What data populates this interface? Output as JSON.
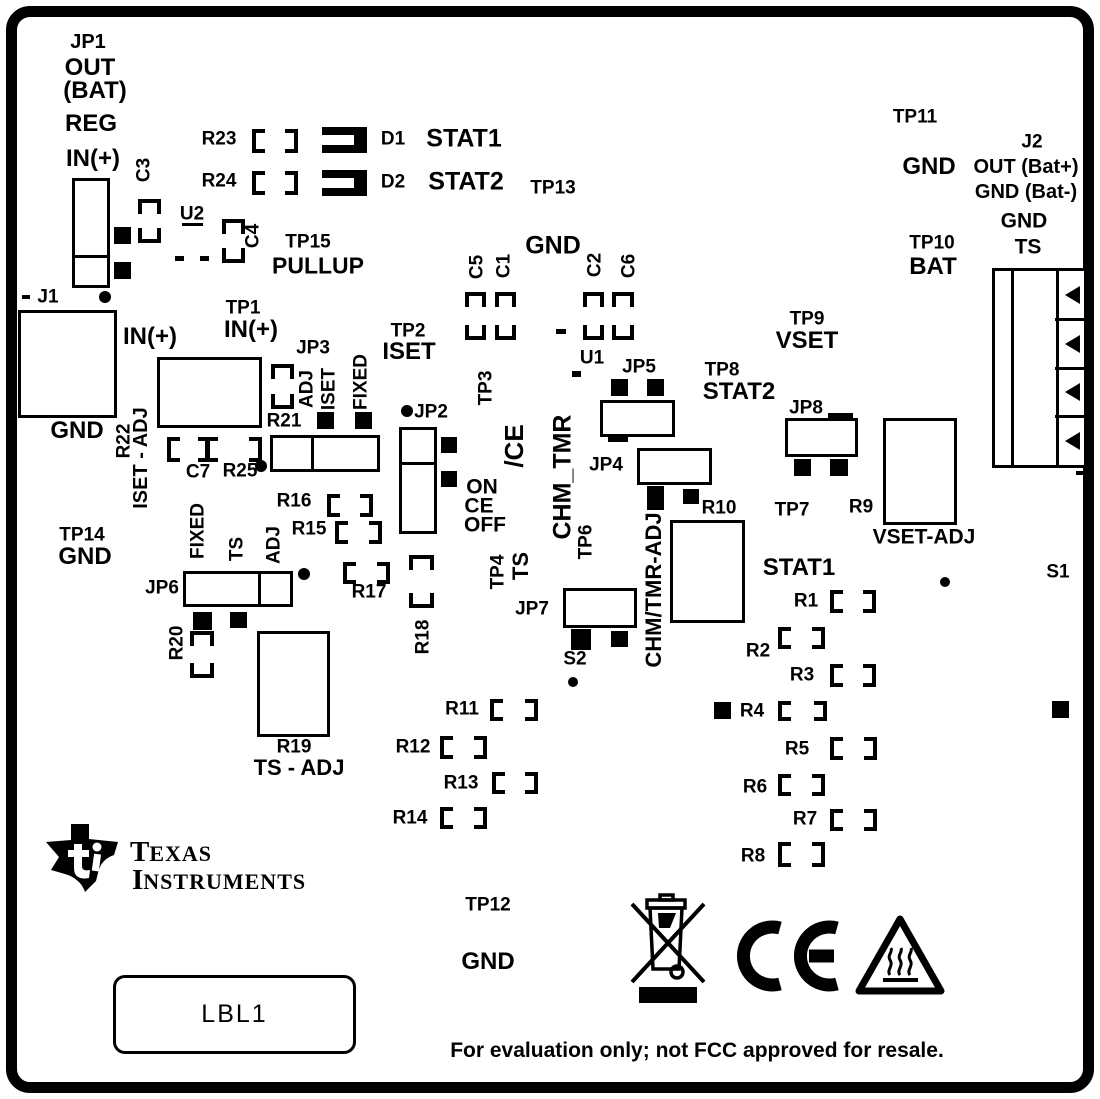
{
  "board": {
    "bg": "#ffffff",
    "ink": "#000000"
  },
  "brand": {
    "t1i": "T",
    "t1r": "EXAS",
    "t2i": "I",
    "t2r": "NSTRUMENTS"
  },
  "plate": {
    "text": "LBL1"
  },
  "footer": {
    "text": "For evaluation only; not FCC approved for resale."
  },
  "labels": [
    [
      "JP1",
      88,
      42,
      20,
      ""
    ],
    [
      "OUT",
      90,
      68,
      24,
      ""
    ],
    [
      "(BAT)",
      95,
      91,
      24,
      ""
    ],
    [
      "REG",
      91,
      124,
      24,
      ""
    ],
    [
      "IN(+)",
      93,
      159,
      24,
      ""
    ],
    [
      "C3",
      144,
      170,
      19,
      "v"
    ],
    [
      "U2",
      192,
      214,
      19,
      ""
    ],
    [
      "C4",
      253,
      236,
      19,
      "v"
    ],
    [
      "TP15",
      308,
      242,
      19,
      ""
    ],
    [
      "PULLUP",
      318,
      266,
      23,
      ""
    ],
    [
      "R23",
      219,
      139,
      19,
      ""
    ],
    [
      "R24",
      219,
      181,
      19,
      ""
    ],
    [
      "D1",
      393,
      139,
      19,
      ""
    ],
    [
      "STAT1",
      464,
      139,
      25,
      ""
    ],
    [
      "D2",
      393,
      182,
      19,
      ""
    ],
    [
      "STAT2",
      466,
      182,
      25,
      ""
    ],
    [
      "TP13",
      553,
      188,
      19,
      ""
    ],
    [
      "GND",
      553,
      246,
      25,
      ""
    ],
    [
      "C5",
      477,
      267,
      19,
      "v"
    ],
    [
      "C1",
      504,
      266,
      19,
      "v"
    ],
    [
      "C2",
      595,
      265,
      19,
      "v"
    ],
    [
      "C6",
      629,
      266,
      19,
      "v"
    ],
    [
      "TP11",
      915,
      117,
      19,
      ""
    ],
    [
      "GND",
      929,
      167,
      24,
      ""
    ],
    [
      "J2",
      1032,
      142,
      19,
      ""
    ],
    [
      "OUT (Bat+)",
      1026,
      167,
      20,
      ""
    ],
    [
      "GND (Bat-)",
      1026,
      192,
      20,
      ""
    ],
    [
      "GND",
      1024,
      221,
      21,
      ""
    ],
    [
      "TS",
      1028,
      247,
      21,
      ""
    ],
    [
      "TP10",
      932,
      243,
      19,
      ""
    ],
    [
      "BAT",
      933,
      267,
      24,
      ""
    ],
    [
      "J1",
      48,
      297,
      19,
      ""
    ],
    [
      "IN(+)",
      150,
      337,
      24,
      ""
    ],
    [
      "GND",
      77,
      431,
      24,
      ""
    ],
    [
      "TP1",
      243,
      308,
      19,
      ""
    ],
    [
      "IN(+)",
      251,
      330,
      24,
      ""
    ],
    [
      "TP2",
      408,
      331,
      19,
      ""
    ],
    [
      "ISET",
      409,
      352,
      24,
      ""
    ],
    [
      "JP3",
      313,
      348,
      19,
      ""
    ],
    [
      "ADJ",
      307,
      389,
      19,
      "v"
    ],
    [
      "ISET",
      329,
      389,
      19,
      "v"
    ],
    [
      "FIXED",
      361,
      382,
      19,
      "v"
    ],
    [
      "R22",
      124,
      441,
      19,
      "v"
    ],
    [
      "ISET - ADJ",
      141,
      458,
      20,
      "v"
    ],
    [
      "R21",
      284,
      421,
      19,
      ""
    ],
    [
      "C7",
      198,
      472,
      19,
      ""
    ],
    [
      "R25",
      240,
      471,
      19,
      ""
    ],
    [
      "TP9",
      807,
      319,
      19,
      ""
    ],
    [
      "VSET",
      807,
      341,
      24,
      ""
    ],
    [
      "U1",
      592,
      358,
      19,
      ""
    ],
    [
      "JP5",
      639,
      367,
      19,
      ""
    ],
    [
      "TP8",
      722,
      370,
      19,
      ""
    ],
    [
      "STAT2",
      739,
      392,
      24,
      ""
    ],
    [
      "JP2",
      431,
      412,
      19,
      ""
    ],
    [
      "ON",
      482,
      487,
      21,
      ""
    ],
    [
      "CE",
      479,
      506,
      21,
      ""
    ],
    [
      "OFF",
      485,
      525,
      21,
      ""
    ],
    [
      "/CE",
      514,
      446,
      26,
      "v"
    ],
    [
      "TP3",
      486,
      388,
      19,
      "v"
    ],
    [
      "CHM_TMR",
      563,
      477,
      25,
      "v"
    ],
    [
      "JP4",
      606,
      465,
      19,
      ""
    ],
    [
      "JP8",
      806,
      408,
      19,
      ""
    ],
    [
      "R9",
      861,
      507,
      19,
      ""
    ],
    [
      "VSET-ADJ",
      924,
      537,
      21,
      ""
    ],
    [
      "TP7",
      792,
      510,
      19,
      ""
    ],
    [
      "R10",
      719,
      508,
      19,
      ""
    ],
    [
      "CHM/TMR-ADJ",
      654,
      590,
      22,
      "v"
    ],
    [
      "TP4",
      498,
      572,
      19,
      "v"
    ],
    [
      "TS",
      521,
      566,
      22,
      "v"
    ],
    [
      "TP6",
      586,
      542,
      19,
      "v"
    ],
    [
      "JP7",
      532,
      609,
      19,
      ""
    ],
    [
      "S2",
      575,
      659,
      19,
      ""
    ],
    [
      "R18",
      423,
      637,
      19,
      "v"
    ],
    [
      "R16",
      294,
      501,
      19,
      ""
    ],
    [
      "R15",
      309,
      529,
      19,
      ""
    ],
    [
      "R17",
      369,
      592,
      19,
      ""
    ],
    [
      "TP14",
      82,
      535,
      19,
      ""
    ],
    [
      "GND",
      85,
      557,
      24,
      ""
    ],
    [
      "FIXED",
      198,
      531,
      19,
      "v"
    ],
    [
      "TS",
      237,
      549,
      19,
      "v"
    ],
    [
      "ADJ",
      274,
      545,
      19,
      "v"
    ],
    [
      "JP6",
      162,
      588,
      19,
      ""
    ],
    [
      "R20",
      177,
      643,
      19,
      "v"
    ],
    [
      "R19",
      294,
      747,
      19,
      ""
    ],
    [
      "TS - ADJ",
      299,
      768,
      22,
      ""
    ],
    [
      "STAT1",
      799,
      568,
      24,
      ""
    ],
    [
      "R1",
      806,
      601,
      19,
      ""
    ],
    [
      "R2",
      758,
      651,
      19,
      ""
    ],
    [
      "R3",
      802,
      675,
      19,
      ""
    ],
    [
      "R4",
      752,
      711,
      19,
      ""
    ],
    [
      "R5",
      797,
      749,
      19,
      ""
    ],
    [
      "R6",
      755,
      787,
      19,
      ""
    ],
    [
      "R7",
      805,
      819,
      19,
      ""
    ],
    [
      "R8",
      753,
      856,
      19,
      ""
    ],
    [
      "R11",
      462,
      709,
      19,
      ""
    ],
    [
      "R12",
      413,
      747,
      19,
      ""
    ],
    [
      "R13",
      461,
      783,
      19,
      ""
    ],
    [
      "R14",
      410,
      818,
      19,
      ""
    ],
    [
      "S1",
      1058,
      572,
      19,
      ""
    ],
    [
      "TP12",
      488,
      905,
      19,
      ""
    ],
    [
      "GND",
      488,
      962,
      24,
      ""
    ]
  ],
  "rects": [
    [
      "jp1-jumper",
      72,
      178,
      38,
      110,
      "h",
      74
    ],
    [
      "j1-connector",
      18,
      310,
      99,
      108,
      "",
      0
    ],
    [
      "r22-pot",
      157,
      357,
      105,
      71,
      "",
      0
    ],
    [
      "jp3-jumper",
      270,
      435,
      110,
      37,
      "v",
      38
    ],
    [
      "jp2-jumper",
      399,
      427,
      38,
      107,
      "h",
      32
    ],
    [
      "jp6-jumper",
      183,
      571,
      110,
      36,
      "v",
      72
    ],
    [
      "r19-pot",
      257,
      631,
      73,
      106,
      "",
      0
    ],
    [
      "jp5",
      600,
      400,
      75,
      37,
      "",
      0
    ],
    [
      "jp4",
      637,
      448,
      75,
      37,
      "",
      0
    ],
    [
      "jp7",
      563,
      588,
      74,
      40,
      "",
      0
    ],
    [
      "jp8",
      785,
      418,
      73,
      39,
      "",
      0
    ],
    [
      "r9-pot",
      883,
      418,
      74,
      107,
      "",
      0
    ],
    [
      "r10-pot",
      670,
      520,
      75,
      103,
      "",
      0
    ]
  ],
  "hpads": [
    [
      "r23-pads",
      252,
      129,
      46,
      24
    ],
    [
      "r24-pads",
      252,
      171,
      46,
      24
    ],
    [
      "r16-pads",
      327,
      494,
      46,
      23
    ],
    [
      "r15-pads",
      335,
      521,
      47,
      23
    ],
    [
      "r17-pads",
      343,
      562,
      47,
      22
    ],
    [
      "r1-pads",
      830,
      590,
      46,
      23
    ],
    [
      "r2-pads",
      778,
      627,
      47,
      22
    ],
    [
      "r3-pads",
      830,
      664,
      46,
      23
    ],
    [
      "r4-pads",
      778,
      701,
      49,
      20
    ],
    [
      "r5-pads",
      830,
      737,
      47,
      23
    ],
    [
      "r6-pads",
      778,
      774,
      47,
      22
    ],
    [
      "r7-pads",
      830,
      809,
      47,
      22
    ],
    [
      "r8-pads",
      778,
      842,
      47,
      25
    ],
    [
      "r11-pads",
      490,
      699,
      48,
      22
    ],
    [
      "r12-pads",
      440,
      736,
      47,
      23
    ],
    [
      "r13-pads",
      492,
      772,
      46,
      22
    ],
    [
      "r14-pads",
      440,
      807,
      47,
      22
    ]
  ],
  "vpads": [
    [
      "c3-pads",
      138,
      199,
      23,
      44
    ],
    [
      "c4-pads",
      222,
      219,
      23,
      44
    ],
    [
      "c5-pads",
      465,
      292,
      21,
      48
    ],
    [
      "c1-pads",
      495,
      292,
      21,
      48
    ],
    [
      "c2-pads",
      583,
      292,
      21,
      48
    ],
    [
      "c6-pads",
      612,
      292,
      22,
      48
    ],
    [
      "r21-pads",
      271,
      364,
      23,
      45
    ],
    [
      "r18-pads",
      409,
      555,
      25,
      53
    ],
    [
      "r20-pads",
      190,
      631,
      24,
      47
    ]
  ],
  "squares": [
    [
      114,
      227,
      17,
      17,
      "jp1-pad"
    ],
    [
      114,
      262,
      17,
      17,
      "jp1-pad"
    ],
    [
      317,
      412,
      17,
      17,
      "jp3-pad"
    ],
    [
      355,
      412,
      17,
      17,
      "jp3-pad"
    ],
    [
      441,
      437,
      16,
      16,
      "jp2-pad"
    ],
    [
      441,
      471,
      16,
      16,
      "jp2-pad"
    ],
    [
      193,
      612,
      19,
      18,
      "jp6-pad"
    ],
    [
      230,
      612,
      17,
      16,
      "jp6-pad"
    ],
    [
      611,
      379,
      17,
      17,
      "jp5-pad"
    ],
    [
      647,
      379,
      17,
      17,
      "jp5-pad"
    ],
    [
      647,
      486,
      17,
      24,
      "jp4-pad"
    ],
    [
      683,
      489,
      16,
      15,
      "jp4-pad"
    ],
    [
      571,
      629,
      20,
      21,
      "jp7-pad"
    ],
    [
      611,
      631,
      17,
      16,
      "jp7-pad"
    ],
    [
      794,
      459,
      17,
      17,
      "jp8-pad"
    ],
    [
      830,
      459,
      18,
      17,
      "jp8-pad"
    ],
    [
      714,
      702,
      17,
      17,
      "r4-pad"
    ],
    [
      1052,
      701,
      17,
      17,
      "s1-pad"
    ]
  ],
  "dots": [
    [
      105,
      297,
      6
    ],
    [
      407,
      411,
      6
    ],
    [
      261,
      466,
      6
    ],
    [
      304,
      574,
      6
    ],
    [
      573,
      682,
      5
    ],
    [
      945,
      582,
      5
    ]
  ],
  "marks": [
    [
      175,
      256,
      9,
      5
    ],
    [
      200,
      256,
      9,
      5
    ],
    [
      22,
      295,
      8,
      4
    ],
    [
      182,
      223,
      21,
      3
    ],
    [
      556,
      329,
      10,
      5
    ],
    [
      572,
      371,
      9,
      6
    ],
    [
      608,
      437,
      20,
      5
    ],
    [
      828,
      413,
      25,
      5
    ],
    [
      1076,
      471,
      11,
      4
    ]
  ],
  "leds": [
    [
      "d1-led",
      322,
      127,
      45,
      26
    ],
    [
      "d2-led",
      322,
      170,
      45,
      26
    ]
  ],
  "c7": {
    "x": 167,
    "y": 437,
    "w": 95,
    "h": 25
  },
  "j2": {
    "x": 992,
    "y": 268,
    "w": 95,
    "h": 200,
    "strip": 16,
    "col": 61,
    "rows": 4
  }
}
